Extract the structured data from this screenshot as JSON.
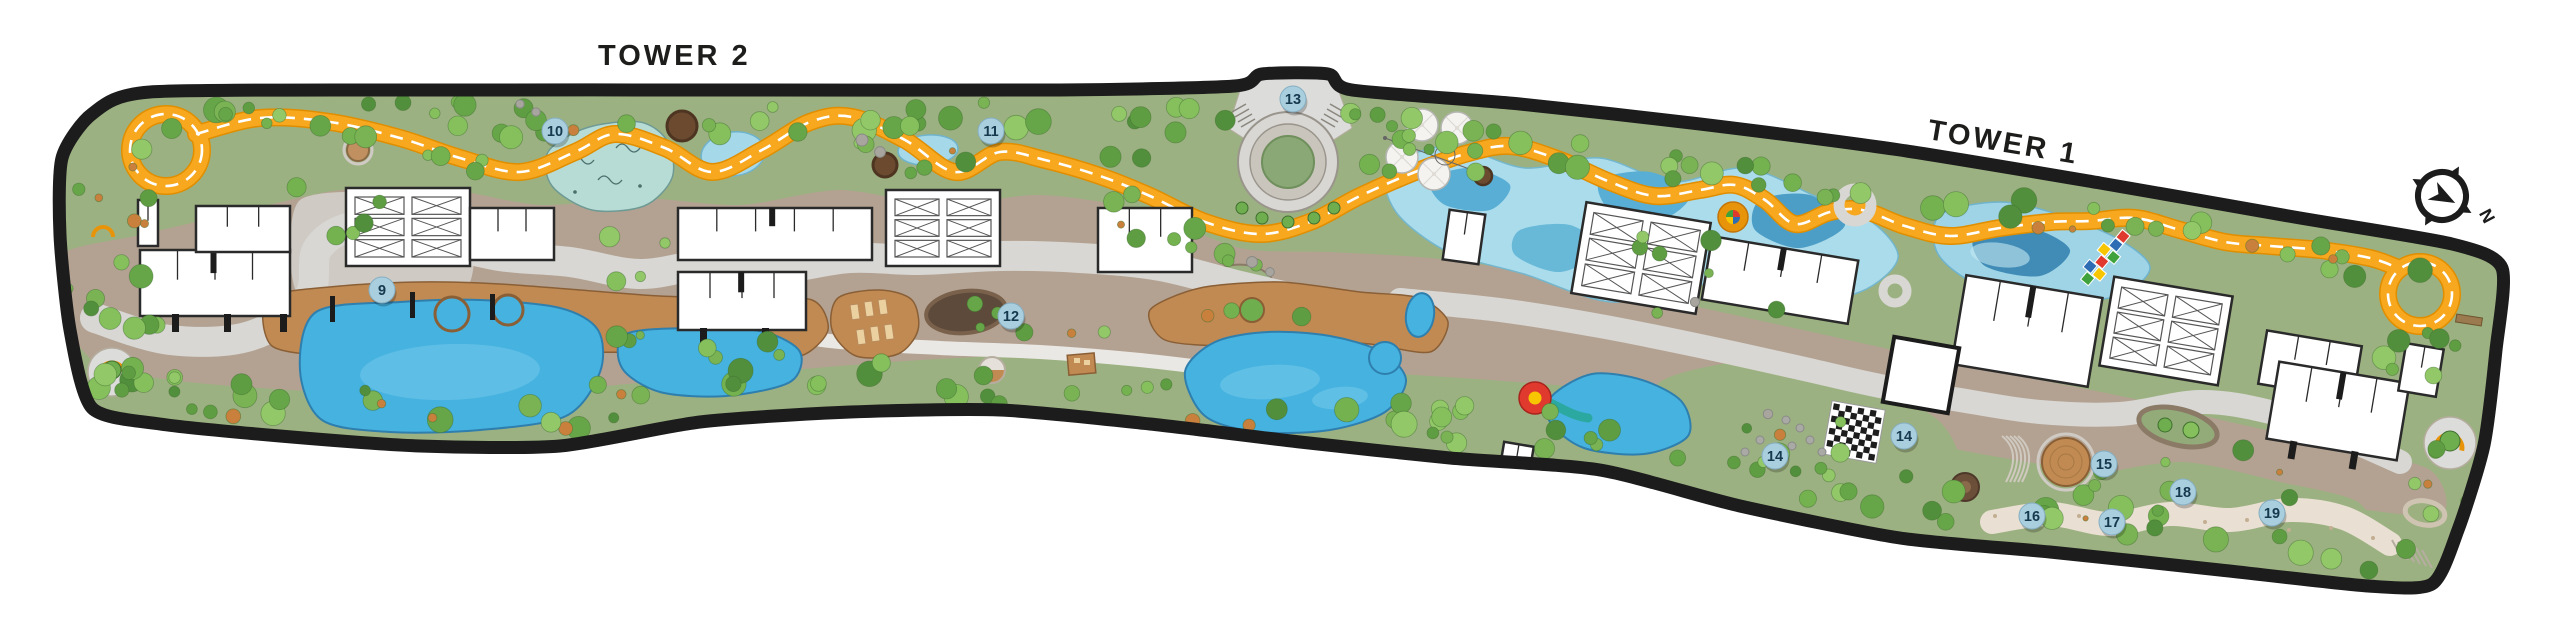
{
  "plan": {
    "tower2_label": "TOWER 2",
    "tower1_label": "TOWER 1",
    "compass_label": "N",
    "markers": [
      {
        "num": "9",
        "x": 382,
        "y": 290
      },
      {
        "num": "10",
        "x": 555,
        "y": 131
      },
      {
        "num": "11",
        "x": 991,
        "y": 131
      },
      {
        "num": "12",
        "x": 1011,
        "y": 316
      },
      {
        "num": "13",
        "x": 1293,
        "y": 99
      },
      {
        "num": "14",
        "x": 1775,
        "y": 456
      },
      {
        "num": "14",
        "x": 1904,
        "y": 436
      },
      {
        "num": "15",
        "x": 2104,
        "y": 464
      },
      {
        "num": "16",
        "x": 2032,
        "y": 516
      },
      {
        "num": "17",
        "x": 2112,
        "y": 522
      },
      {
        "num": "18",
        "x": 2183,
        "y": 492
      },
      {
        "num": "19",
        "x": 2272,
        "y": 513
      }
    ],
    "colors": {
      "track_orange": "#F7A81F",
      "track_edge": "#E08E00",
      "marker_fill": "#A9CEDE",
      "marker_stroke": "#85AEC2",
      "marker_text": "#16394E",
      "water": "#45B2E0",
      "water_light": "#AADCEC",
      "water_deep": "#2F7FAE",
      "greenery": "#9CB181",
      "hardscape": "#B3A292",
      "path_light": "#D9D8D4",
      "deck_wood": "#C08A52",
      "building": "#FFFFFF",
      "border": "#1C1C1C",
      "label_text": "#1D1D1B"
    }
  }
}
